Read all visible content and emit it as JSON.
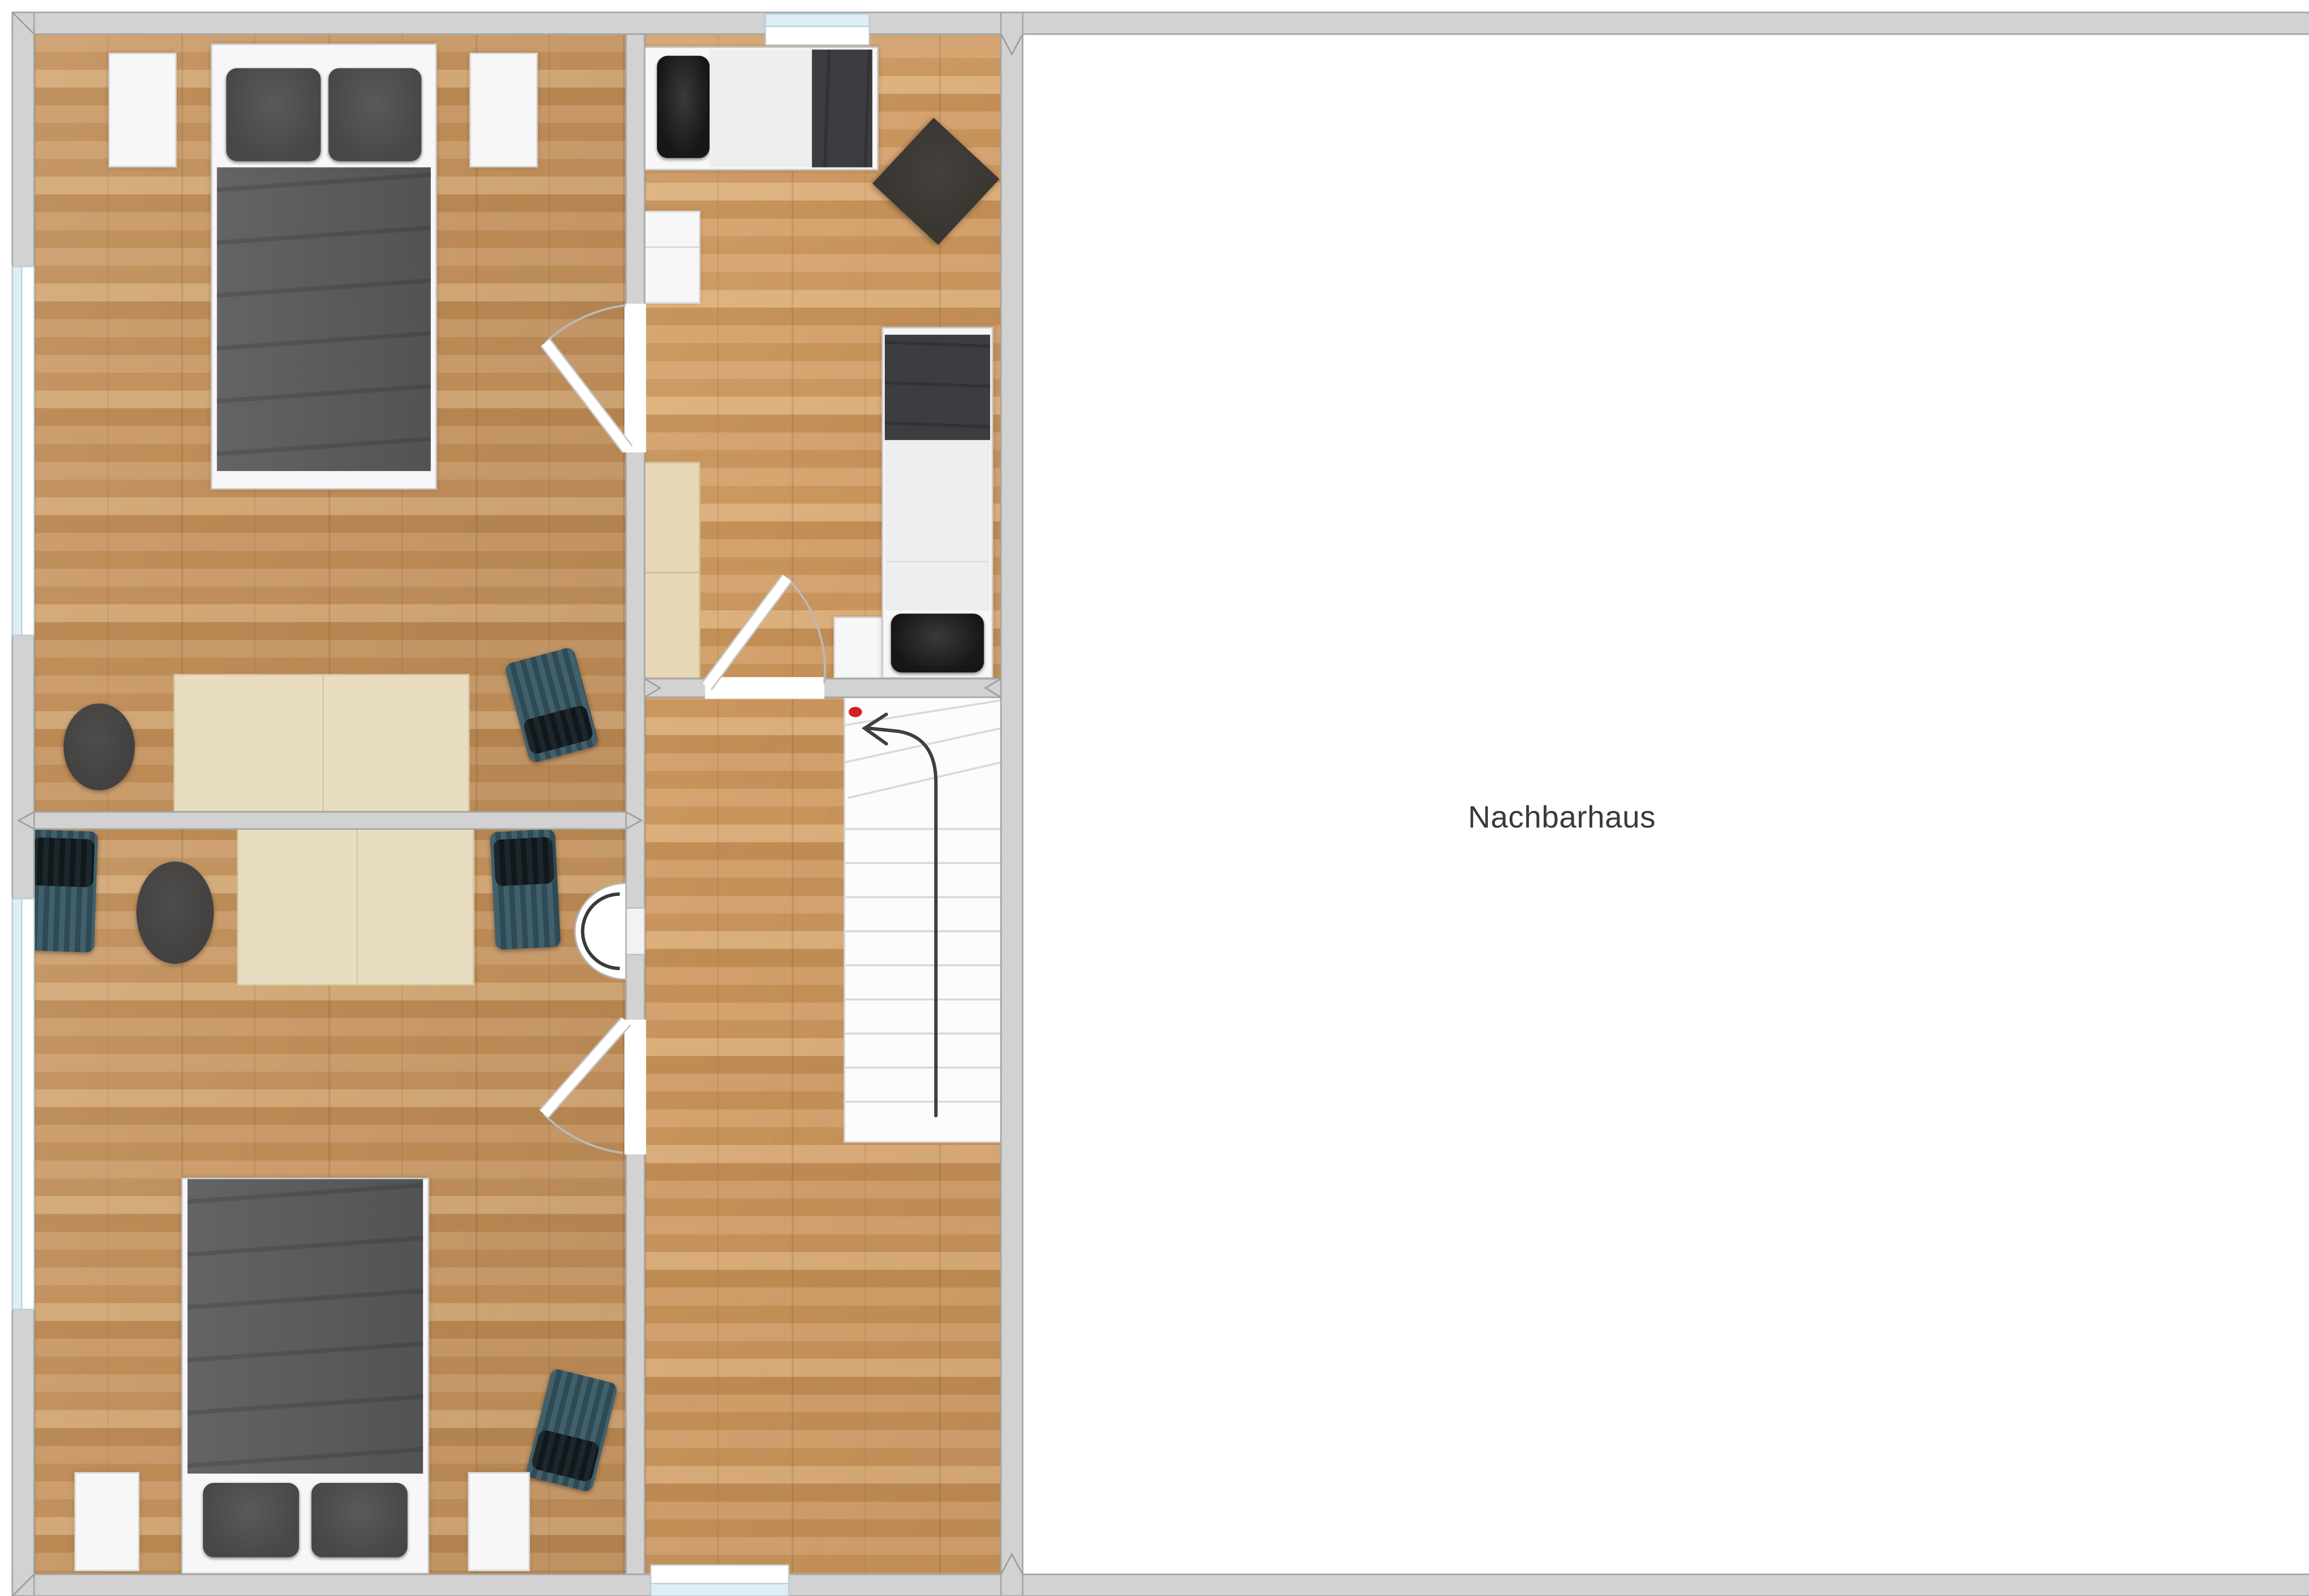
{
  "labels": {
    "neighbor_house": "Nachbarhaus"
  },
  "colors": {
    "wall-fill": "#d2d2d2",
    "wall-edge": "#a6a6a6",
    "wood-base": "#c49566",
    "neighbor-floor": "#ffffff",
    "window-blue": "#ddeef5",
    "furn-white": "#f7f7f7",
    "furn-white-edge": "#d9d9d9",
    "desk-beige": "#e9ddc1",
    "desk-edge": "#d6c9a7",
    "cabinet-tan": "#e6d7b6",
    "cabinet-tan-edge": "#d2bf97",
    "duvet": "#595a5c",
    "pillow-gray": "#474749",
    "pillow-black": "#17171a",
    "mattress": "#eeeeef",
    "blanket-dark": "#3c3d40",
    "pouf": "#434140",
    "diamond": "#3a3632",
    "chair-teal-1": "#41606c",
    "chair-teal-2": "#2e4a54",
    "chair-black": "#10181c",
    "stair-white": "#fcfcfc",
    "stair-line": "#d6d6d6",
    "arrow": "#3f3f3f",
    "red-dot": "#d71f1f",
    "label-color": "#3a3a3a"
  },
  "plan": {
    "type": "floor-plan",
    "rooms": [
      {
        "id": "bedroom-top-left",
        "floor": "wood",
        "furniture": [
          "double-bed-gray-duvet",
          "nightstand",
          "nightstand",
          "desk-two-part",
          "pouf-oval",
          "office-chair-teal"
        ]
      },
      {
        "id": "bedroom-bottom-left",
        "floor": "wood",
        "furniture": [
          "double-bed-gray-duvet",
          "nightstand",
          "nightstand",
          "desk-two-part",
          "pouf-oval",
          "office-chair-teal",
          "office-chair-teal",
          "office-chair-teal",
          "wall-basin"
        ]
      },
      {
        "id": "bedroom-middle",
        "floor": "wood",
        "furniture": [
          "single-bed-horizontal",
          "single-bed-vertical",
          "cushion-diamond",
          "cabinet-white",
          "cabinet-tan",
          "nightstand"
        ]
      },
      {
        "id": "hallway",
        "floor": "wood",
        "features": [
          "staircase",
          "stair-direction-arrow",
          "red-marker",
          "window-bottom"
        ]
      },
      {
        "id": "neighbor-house",
        "floor": "empty-white",
        "label": "Nachbarhaus"
      }
    ],
    "doors": [
      {
        "between": "bedroom-middle / bedroom-top-left",
        "swing": "into top-left room"
      },
      {
        "between": "bedroom-middle / hallway",
        "swing": "into middle room"
      },
      {
        "between": "hallway / bedroom-bottom-left",
        "swing": "into bottom-left room"
      }
    ],
    "windows": [
      "left-wall-upper",
      "left-wall-lower",
      "top-wall-middle-room",
      "bottom-wall-hallway"
    ],
    "stairs": {
      "arrow_direction": "up then curving left",
      "marker": "red-dot"
    }
  }
}
